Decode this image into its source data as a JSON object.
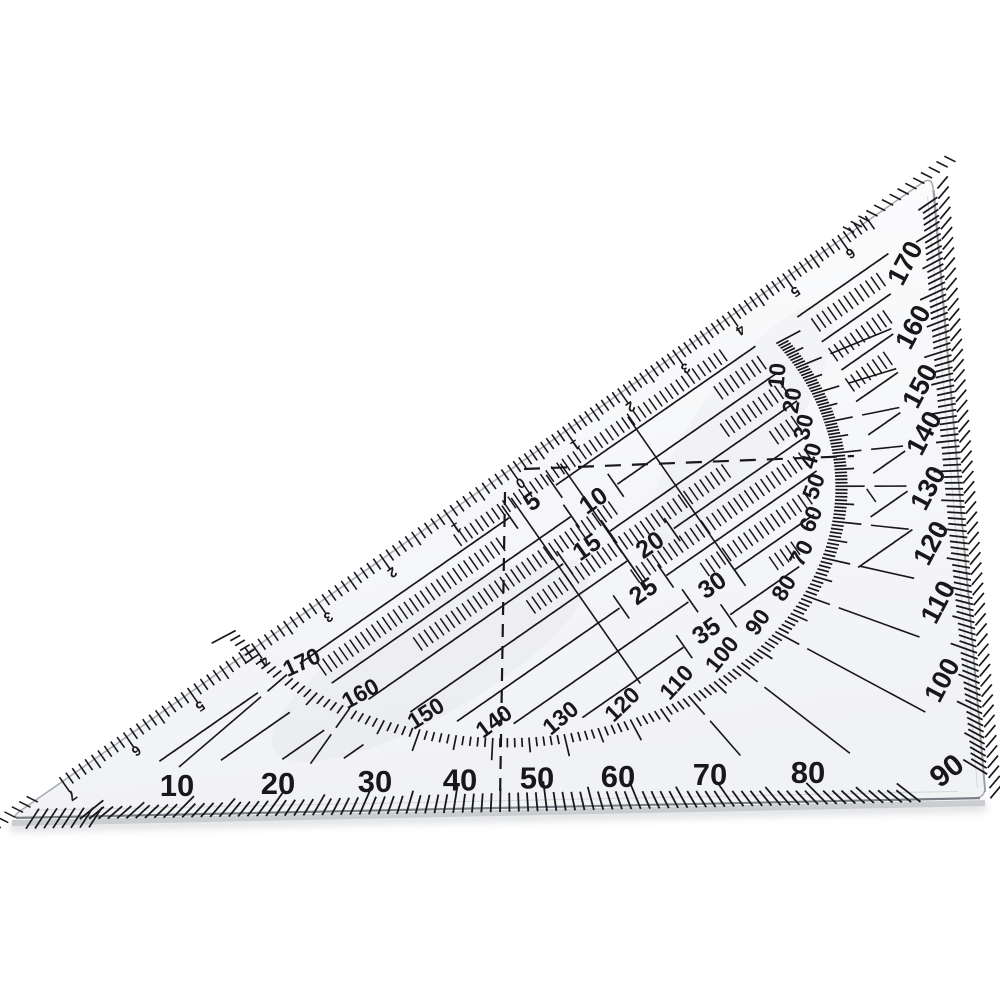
{
  "scales": {
    "bottom_degrees": [
      "10",
      "20",
      "30",
      "40",
      "50",
      "60",
      "70",
      "80"
    ],
    "corner_degree": "90",
    "right_degrees": [
      "100",
      "110",
      "120",
      "130",
      "140",
      "150",
      "160",
      "170"
    ],
    "inner_ring_degrees": [
      "170",
      "160",
      "150",
      "140",
      "130",
      "120",
      "110",
      "100",
      "90",
      "80",
      "70",
      "60",
      "50",
      "40",
      "30",
      "20",
      "10"
    ],
    "hyp_cm_right": [
      "0",
      "1",
      "2",
      "3",
      "4",
      "5",
      "6"
    ],
    "hyp_cm_left": [
      "1",
      "2",
      "3",
      "4",
      "5",
      "6",
      "7"
    ],
    "offset_mm": [
      "5",
      "10",
      "15",
      "20",
      "25",
      "30",
      "35"
    ]
  },
  "colors": {
    "ink": "#18181a",
    "body_top": "#fdfdfe",
    "body_bottom": "#f1f2f4",
    "edge": "#a9aeb6",
    "edge_dark": "#70757d",
    "inset_line": "#d5d7da",
    "shadow": "#c6c9cd",
    "background": "#ffffff"
  }
}
